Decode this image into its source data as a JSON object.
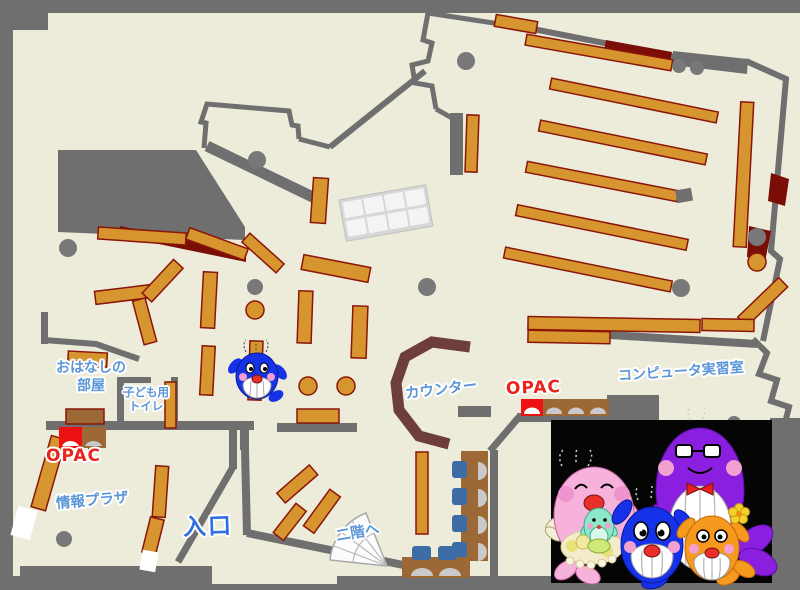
{
  "map": {
    "labels": {
      "storytelling_l1": "おはなしの",
      "storytelling_l2": "部屋",
      "toilet_l1": "子ども用",
      "toilet_l2": "トイレ",
      "opac_left": "OPAC",
      "opac_right": "OPAC",
      "counter": "カウンター",
      "computer_room": "コンピュータ実習室",
      "info_plaza": "情報プラザ",
      "entrance": "入口",
      "to_second_floor": "二階へ"
    },
    "colors": {
      "floor": "#edecdb",
      "wall": "#6f6f6f",
      "shelf": "#d6952f",
      "shelf_border": "#8a1508",
      "dark_red": "#7a0e06",
      "counter": "#6e3e3e",
      "furniture_brown": "#9c6836",
      "chair_blue": "#3d6da6",
      "seat_gray": "#c9c9c9",
      "label_blue": "#5b96d8",
      "entrance_blue": "#2f6fe0",
      "opac_red": "#ee1111",
      "photo_background": "#050505",
      "mascot_pink": "#f7b2dc",
      "mascot_blue": "#1532e8",
      "mascot_purple": "#8a1fe0",
      "mascot_orange": "#f5991f",
      "mascot_mint": "#8ce8c8"
    },
    "icons": {
      "center_mascot": "blue-whale-character",
      "family_photo": "whale-family-characters"
    }
  }
}
